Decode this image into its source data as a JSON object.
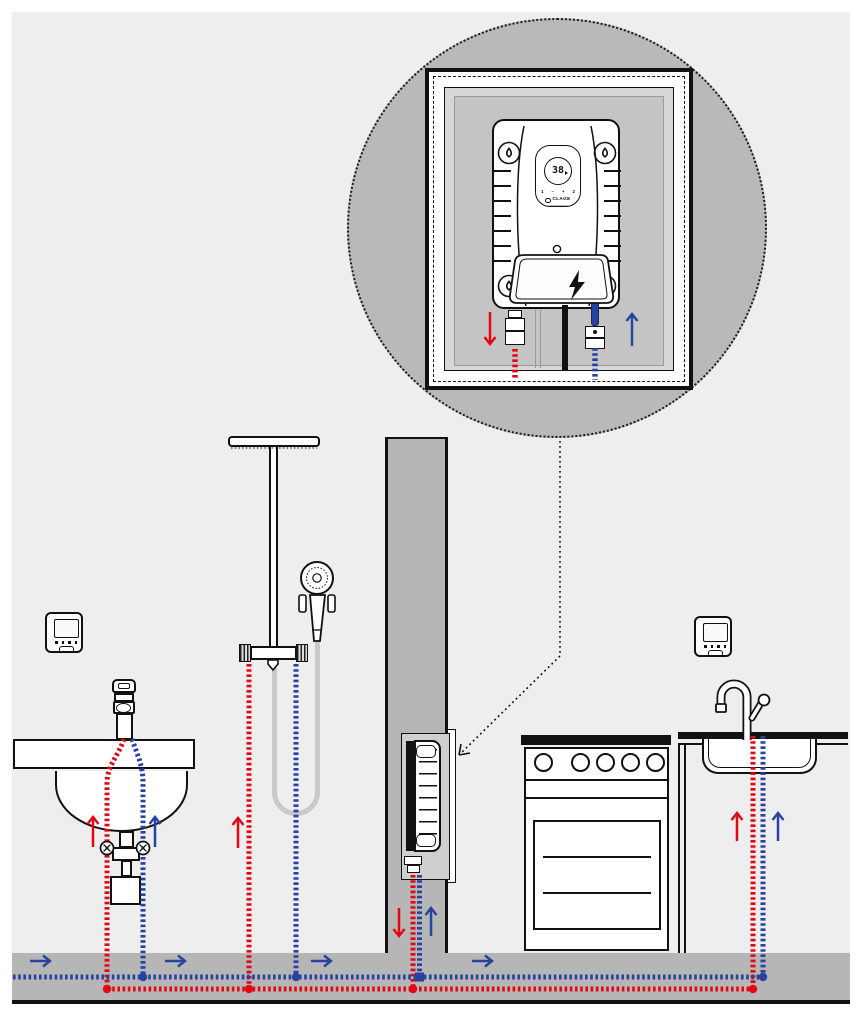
{
  "heater_panel": {
    "display_temperature": "38",
    "button_labels": [
      "1",
      "–",
      "+",
      "2"
    ],
    "brand": "CLAGE"
  },
  "colors": {
    "hot_water_line": "#e30613",
    "cold_water_line": "#2742a0",
    "wall_fill": "#eeeeee",
    "masonry_fill": "#b6b6b6",
    "outline": "#111111"
  }
}
